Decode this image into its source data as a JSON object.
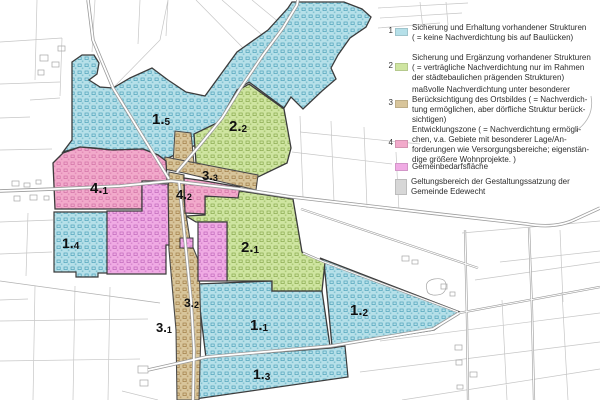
{
  "legend": {
    "items": [
      {
        "num": "1",
        "color": "#b6e0e9",
        "lines": [
          "Sicherung und Erhaltung vorhandener Strukturen",
          "( = keine Nachverdichtung bis auf Baulücken)"
        ]
      },
      {
        "num": "2",
        "color": "#cfe5a1",
        "lines": [
          "Sicherung und Ergänzung vorhandener Strukturen",
          "( = verträgliche Nachverdichtung nur im Rahmen",
          "der städtebaulichen prägenden Strukturen)"
        ]
      },
      {
        "num": "3",
        "color": "#d8c59b",
        "lines": [
          "maßvolle Nachverdichtung unter besonderer",
          "Berücksichtigung des Ortsbildes ( = Nachverdich-",
          "tung ermöglichen, aber dörfliche Struktur berück-",
          "sichtigen)"
        ]
      },
      {
        "num": "4",
        "color": "#f2aacb",
        "lines": [
          "Entwicklungszone ( = Nachverdichtung ermögli-",
          "chen, v.a. Gebiete mit besonderer Lage/An-",
          "forderungen wie Versorgungsbereiche; eigenstän-",
          "dige größere Wohnprojekte. )"
        ]
      },
      {
        "num": "",
        "color": "#f0abe4",
        "lines": [
          "Gemeinbedarfsfläche"
        ]
      },
      {
        "num": "",
        "color": "#d7d7d7",
        "lines": [
          "Geltungsbereich der Gestaltungssatzung der",
          "Gemeinde Edewecht"
        ]
      }
    ]
  },
  "map": {
    "zone_labels": [
      {
        "zone": "1.5",
        "main": "1.",
        "sub": "5"
      },
      {
        "zone": "2.2",
        "main": "2.",
        "sub": "2"
      },
      {
        "zone": "3.3",
        "main": "3.",
        "sub": "3"
      },
      {
        "zone": "4.1",
        "main": "4.",
        "sub": "1"
      },
      {
        "zone": "4.2",
        "main": "4.",
        "sub": "2"
      },
      {
        "zone": "2.1",
        "main": "2.",
        "sub": "1"
      },
      {
        "zone": "1.4",
        "main": "1.",
        "sub": "4"
      },
      {
        "zone": "3.2",
        "main": "3.",
        "sub": "2"
      },
      {
        "zone": "3.1",
        "main": "3.",
        "sub": "1"
      },
      {
        "zone": "1.1",
        "main": "1.",
        "sub": "1"
      },
      {
        "zone": "1.3",
        "main": "1.",
        "sub": "3"
      },
      {
        "zone": "1.2",
        "main": "1.",
        "sub": "2"
      }
    ],
    "palette": {
      "zone1_cyan": "#b6e0e9",
      "zone2_green": "#cfe5a1",
      "zone3_tan": "#d8c59b",
      "zone4_pink": "#f2aacb",
      "gemeinbedarf_magenta": "#f0abe4",
      "geltungsbereich_gray": "#d7d7d7"
    }
  }
}
